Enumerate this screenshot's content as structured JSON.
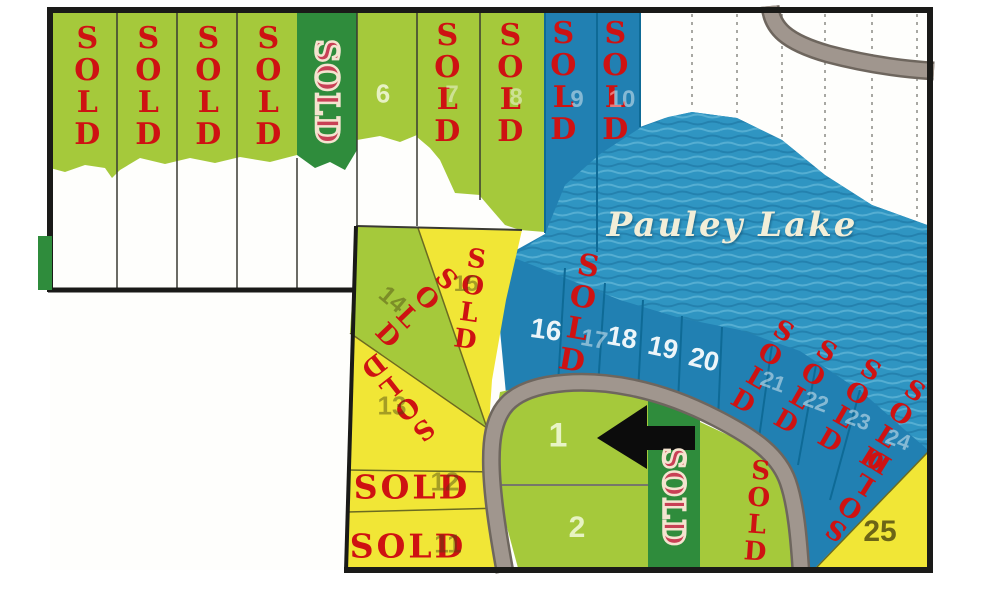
{
  "map": {
    "lake_label": "Pauley Lake",
    "sold_label": "SOLD",
    "lot_numbers": {
      "n1": "1",
      "n2": "2",
      "n6": "6",
      "n7": "7",
      "n8": "8",
      "n9": "9",
      "n10": "10",
      "n11": "11",
      "n12": "12",
      "n13": "13",
      "n14": "14",
      "n15": "15",
      "n16": "16",
      "n17": "17",
      "n18": "18",
      "n19": "19",
      "n20": "20",
      "n21": "21",
      "n22": "22",
      "n23": "23",
      "n24": "24",
      "n25": "25"
    },
    "colors": {
      "lot_green": "#a5c93b",
      "lot_dark_green": "#2f8c3c",
      "lot_yellow": "#f1e636",
      "lot_blue": "#2180b2",
      "water": "#2f95c2",
      "road": "#a0968e",
      "sold_red": "#ce1212",
      "border_black": "#1a1a18",
      "arrow_black": "#0c0c0c"
    }
  }
}
